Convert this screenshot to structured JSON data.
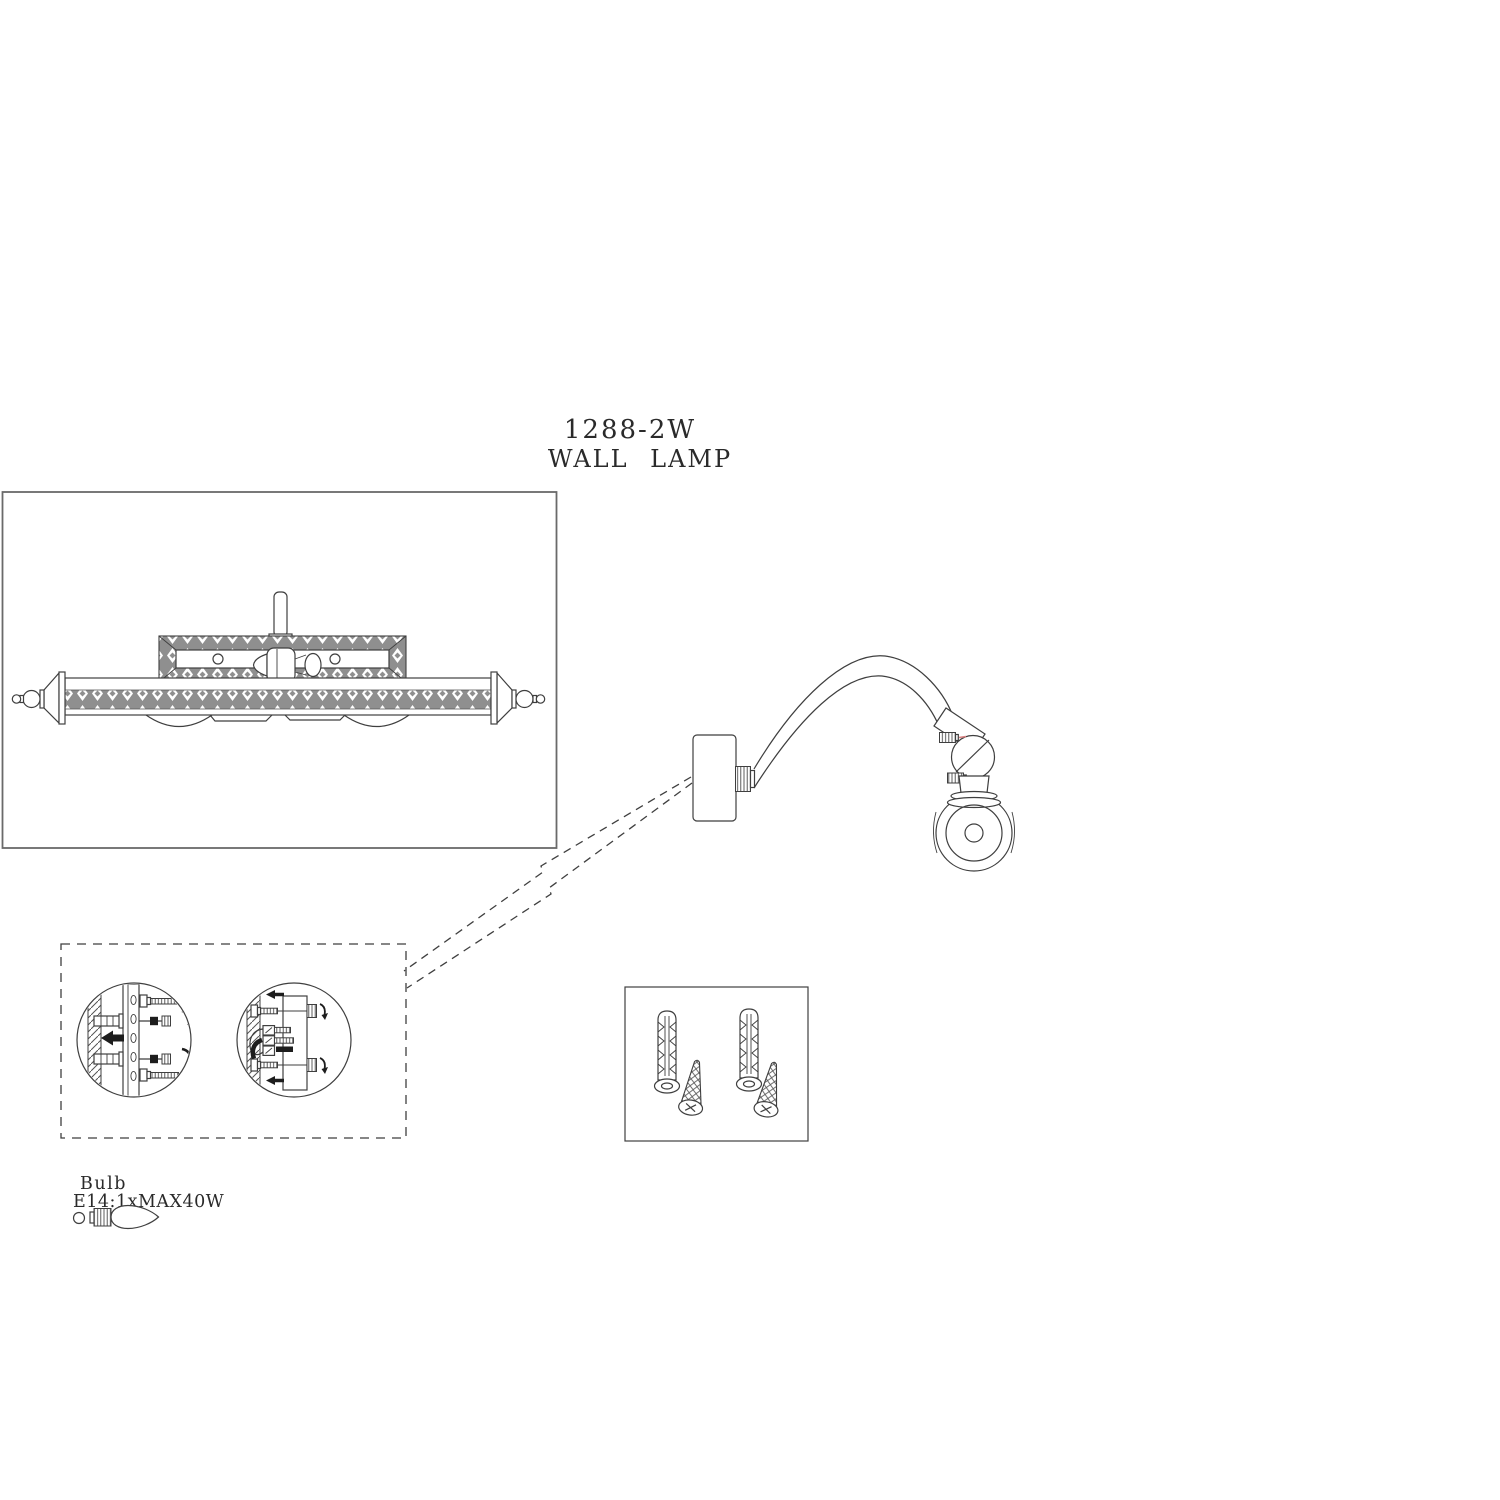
{
  "colors": {
    "background": "#ffffff",
    "line": "#3f3f3f",
    "dark": "#1d1d1d",
    "panel_border": "#6a6a6a",
    "band_fill": "#8f8f8f",
    "accent_red": "#d98080"
  },
  "header": {
    "model": "1288-2W",
    "product_name": "WALL LAMP"
  },
  "bulb_info": {
    "label": "Bulb",
    "spec": "E14:1xMAX40W"
  },
  "figures": {
    "front_view": "wall-lamp-front-view",
    "side_view": "wall-lamp-side-view",
    "mounting_steps": [
      "fix-bracket-with-anchors-and-screws",
      "connect-wires-and-attach-canopy"
    ],
    "hardware": [
      "wall-plug-icon",
      "wall-plug-icon",
      "mounting-screw-icon",
      "mounting-screw-icon"
    ]
  }
}
